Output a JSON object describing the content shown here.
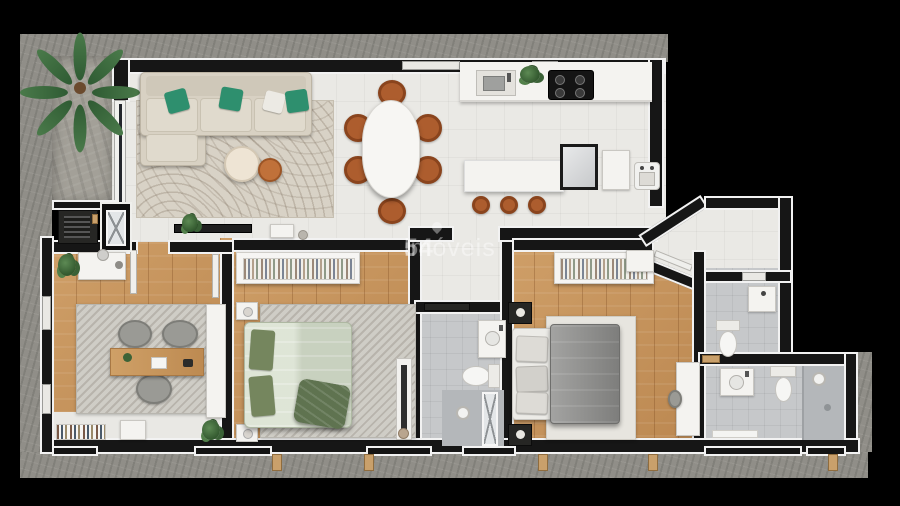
{
  "watermark": {
    "logo_number": "54",
    "brand": "imóveis"
  },
  "palette": {
    "background": "#000000",
    "concrete_wall": "#908e88",
    "interior_wall": "#161616",
    "wall_outline": "#f2f2f2",
    "tile_floor": "#eae9e5",
    "wood_floor": "#c9995f",
    "bathroom_floor": "#c6c8ca",
    "terrace_stone": "#a3a098",
    "sofa_beige": "#d8d1c3",
    "pillow_green": "#2e8f6e",
    "sage_bedding": "#d3dcc9",
    "gray_bedding": "#8c8c8a",
    "terracotta_chairs": "#ad5d2e",
    "plant_green": "#47703f"
  },
  "scene": {
    "type": "apartment-floor-plan-3d-top-view",
    "rooms": [
      {
        "name": "balcony-terrace",
        "items": [
          "palm-plant",
          "bbq-grill",
          "elevator-shaft"
        ]
      },
      {
        "name": "living-room",
        "items": [
          "l-shaped-sofa",
          "green-throw-pillows-x3",
          "white-throw-pillow",
          "patterned-area-rug",
          "round-coffee-table",
          "round-side-table-terracotta",
          "tv-console",
          "potted-plant",
          "side-table"
        ]
      },
      {
        "name": "dining-area",
        "items": [
          "oval-dining-table",
          "dining-chairs-x6"
        ]
      },
      {
        "name": "kitchen",
        "items": [
          "countertop",
          "kitchen-sink",
          "cooktop-4-burners",
          "herb-plant",
          "island-counter",
          "bar-stools-x3",
          "refrigerator",
          "appliance-cabinet",
          "laundry-tub"
        ]
      },
      {
        "name": "home-office",
        "items": [
          "dresser-with-mirror",
          "wood-desk",
          "office-chairs-x3",
          "diagonal-stripe-rug",
          "wardrobe",
          "bookshelf",
          "low-cabinet",
          "potted-plants-x2"
        ]
      },
      {
        "name": "bedroom-2",
        "items": [
          "open-wardrobe-with-clothes",
          "double-bed-sage-bedding",
          "green-pillows-x2",
          "throw-blanket",
          "nightstands-x2",
          "diagonal-stripe-rug",
          "full-length-mirror"
        ]
      },
      {
        "name": "master-bedroom",
        "items": [
          "open-wardrobe-with-clothes",
          "double-bed-gray-bedding",
          "dark-nightstands-x2",
          "light-rug",
          "desk",
          "corner-cabinet"
        ]
      },
      {
        "name": "social-bathroom",
        "items": [
          "vanity-sink",
          "toilet",
          "shower-glass-door",
          "shower-head",
          "sliding-door"
        ]
      },
      {
        "name": "toilet-room",
        "items": [
          "sink-cabinet",
          "toilet"
        ]
      },
      {
        "name": "master-bathroom",
        "items": [
          "vanity-sink",
          "toilet",
          "walk-in-shower",
          "shower-head",
          "bath-mat"
        ]
      }
    ]
  }
}
